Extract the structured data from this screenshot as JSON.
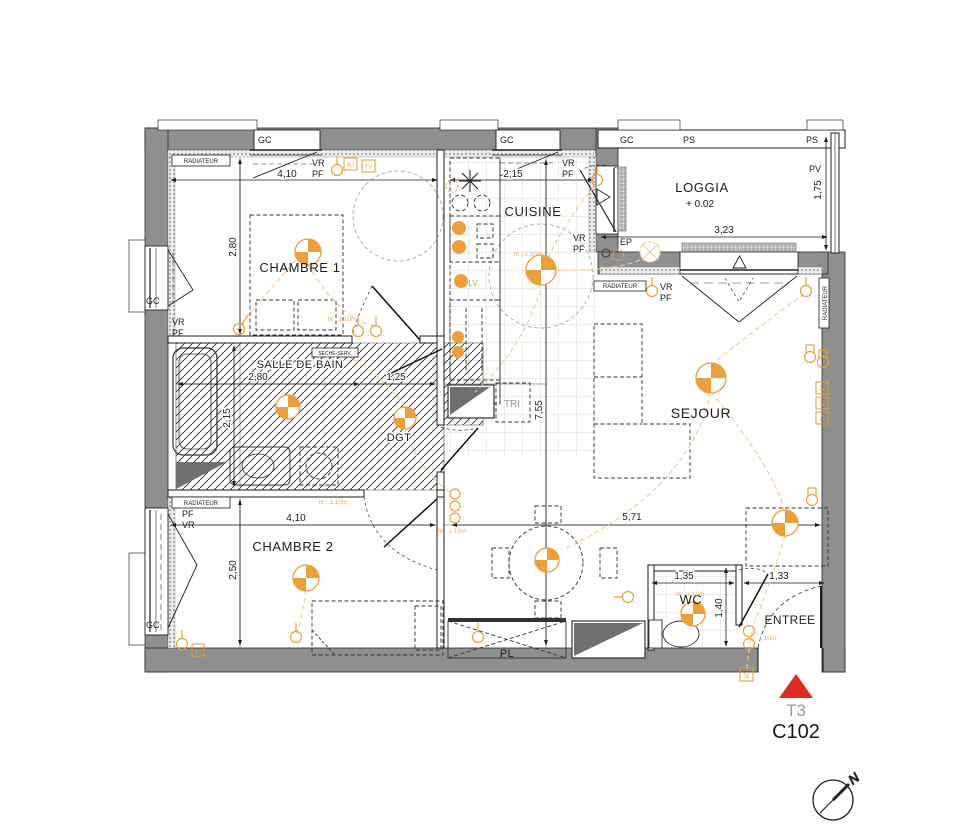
{
  "title": {
    "unit_type": "T3",
    "unit_number": "C102"
  },
  "compass": {
    "north": "N"
  },
  "rooms": {
    "chambre1": "CHAMBRE 1",
    "cuisine": "CUISINE",
    "loggia": "LOGGIA",
    "loggia_level": "+ 0.02",
    "salle_de_bain": "SALLE DE BAIN",
    "dgt": "DGT",
    "sejour": "SEJOUR",
    "chambre2": "CHAMBRE 2",
    "wc": "WC",
    "entree": "ENTREE",
    "pl": "PL",
    "tri": "TRI",
    "lv": "LV",
    "ep": "EP"
  },
  "dims": {
    "chambre1_w": "4,10",
    "chambre1_h": "2,80",
    "cuisine_w": "2,15",
    "loggia_w": "3,23",
    "loggia_d": "1,75",
    "sdb_w": "2,80",
    "sdb_h": "2,15",
    "dgt_w": "1,25",
    "sejour_h": "7,55",
    "sejour_w": "5,71",
    "chambre2_w": "4,10",
    "chambre2_h": "2,50",
    "wc_w": "1,35",
    "wc_h": "1,40",
    "entree_w": "1,33"
  },
  "labels": {
    "gc": "GC",
    "ps": "PS",
    "pv": "PV",
    "vr": "VR",
    "pf": "PF",
    "radiateur": "RADIATEUR",
    "seche_serviette": "SECHE-SERV.",
    "rj": "RJ",
    "tv": "TV",
    "s": "S",
    "height_note": "ht : 1.10m"
  },
  "colors": {
    "wall_gray": "#8f8f8f",
    "line_black": "#1d1d1d",
    "electric_orange": "#ed9f3a",
    "electric_light": "#f2cd96",
    "entrance_red": "#e02b20",
    "muted_gray": "#9a9a9a"
  }
}
